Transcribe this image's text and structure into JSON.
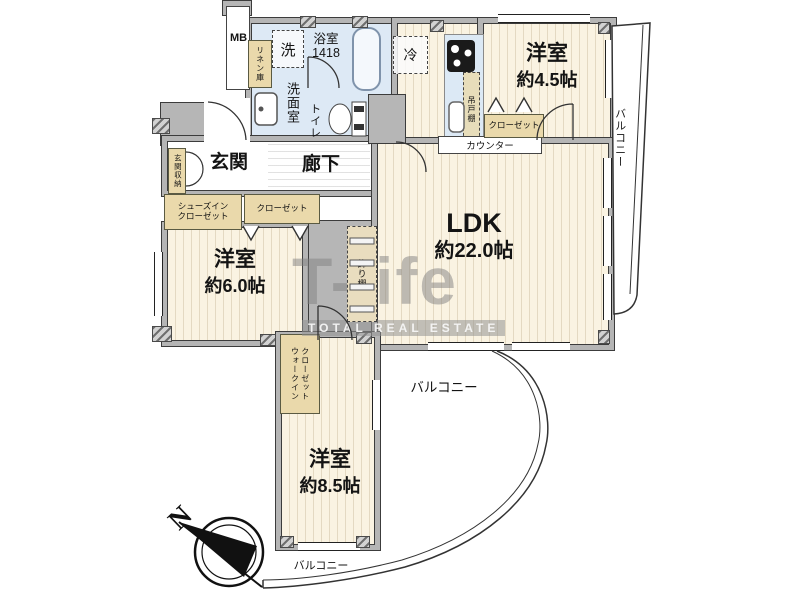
{
  "palette": {
    "wall": "#b5b5b5",
    "floor_wood": "#faf3e2",
    "wet_area": "#dde9f5",
    "closet": "#ead9ab"
  },
  "watermark": {
    "brand": "T-life",
    "subtitle": "TOTAL REAL ESTATE"
  },
  "compass": {
    "north": "N"
  },
  "labels": {
    "mb": "MB",
    "linen": "リネン庫",
    "washer": "洗",
    "bath_name": "浴室",
    "bath_size": "1418",
    "washroom": "洗面室",
    "toilet": "トイレ",
    "fridge": "冷",
    "hanging_cabinet": "吊戸棚",
    "counter": "カウンター",
    "closet45": "クローゼット",
    "room45_name": "洋室",
    "room45_size": "約4.5帖",
    "balcony_right": "バルコニー",
    "entrance": "玄関",
    "entrance_storage": "玄関収納",
    "hallway": "廊下",
    "shoes_closet_1": "シューズイン",
    "shoes_closet_2": "クローゼット",
    "closet_hall": "クローゼット",
    "room60_name": "洋室",
    "room60_size": "約6.0帖",
    "display_shelf": "飾り棚",
    "ldk_name": "LDK",
    "ldk_size": "約22.0帖",
    "balcony_mid": "バルコニー",
    "wic_1": "ウォークイン",
    "wic_2": "クローゼット",
    "room85_name": "洋室",
    "room85_size": "約8.5帖",
    "balcony_bottom": "バルコニー"
  }
}
